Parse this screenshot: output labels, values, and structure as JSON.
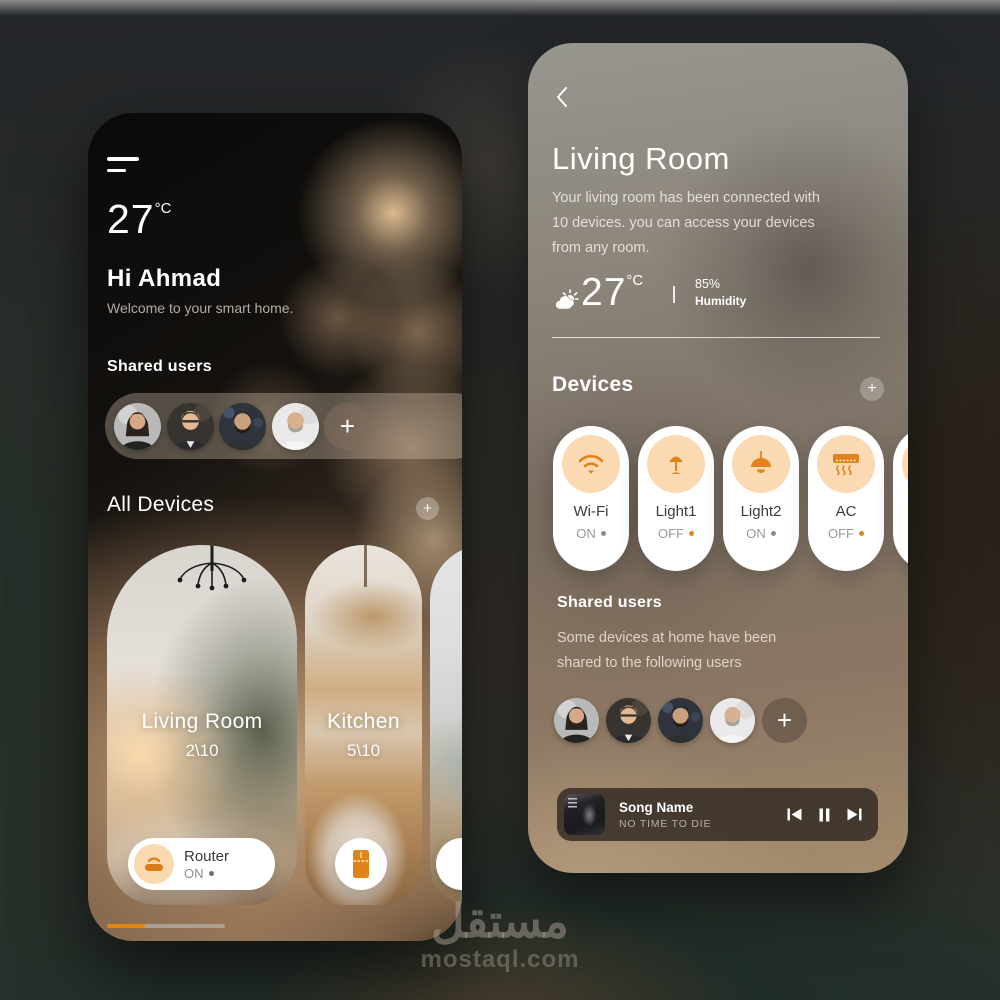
{
  "home": {
    "temperature": "27",
    "temperature_unit": "°C",
    "greeting": "Hi Ahmad",
    "welcome_message": "Welcome to your smart home.",
    "shared_users_label": "Shared users",
    "all_devices_label": "All Devices",
    "add_label": "+",
    "rooms": [
      {
        "name": "Living Room",
        "devices_count": "2\\10"
      },
      {
        "name": "Kitchen",
        "devices_count": "5\\10"
      },
      {
        "name": "dine",
        "devices_count": ""
      }
    ],
    "router_chip": {
      "name": "Router",
      "status": "ON"
    }
  },
  "room": {
    "title": "Living Room",
    "description_line1": "Your living room has been connected with",
    "description_line2": "10 devices. you can access your devices",
    "description_line3": "from any room.",
    "temperature": "27",
    "temperature_unit": "°C",
    "humidity_value": "85%",
    "humidity_label": "Humidity",
    "devices_section_label": "Devices",
    "add_label": "+",
    "devices": [
      {
        "name": "Wi-Fi",
        "status": "ON"
      },
      {
        "name": "Light1",
        "status": "OFF"
      },
      {
        "name": "Light2",
        "status": "ON"
      },
      {
        "name": "AC",
        "status": "OFF"
      }
    ],
    "shared_users_label": "Shared users",
    "shared_users_line1": "Some devices at home have been",
    "shared_users_line2": "shared to the following users",
    "player": {
      "song_title": "Song Name",
      "song_subtitle": "NO TIME TO DIE"
    }
  },
  "watermark": {
    "brand_arabic": "مستقل",
    "brand_domain": "mostaql.com"
  },
  "colors": {
    "accent_orange": "#e0831a",
    "icon_circle_peach": "#fbd9b2",
    "status_on_dot": "#8d8d8d",
    "status_off_dot": "#e8860f"
  }
}
